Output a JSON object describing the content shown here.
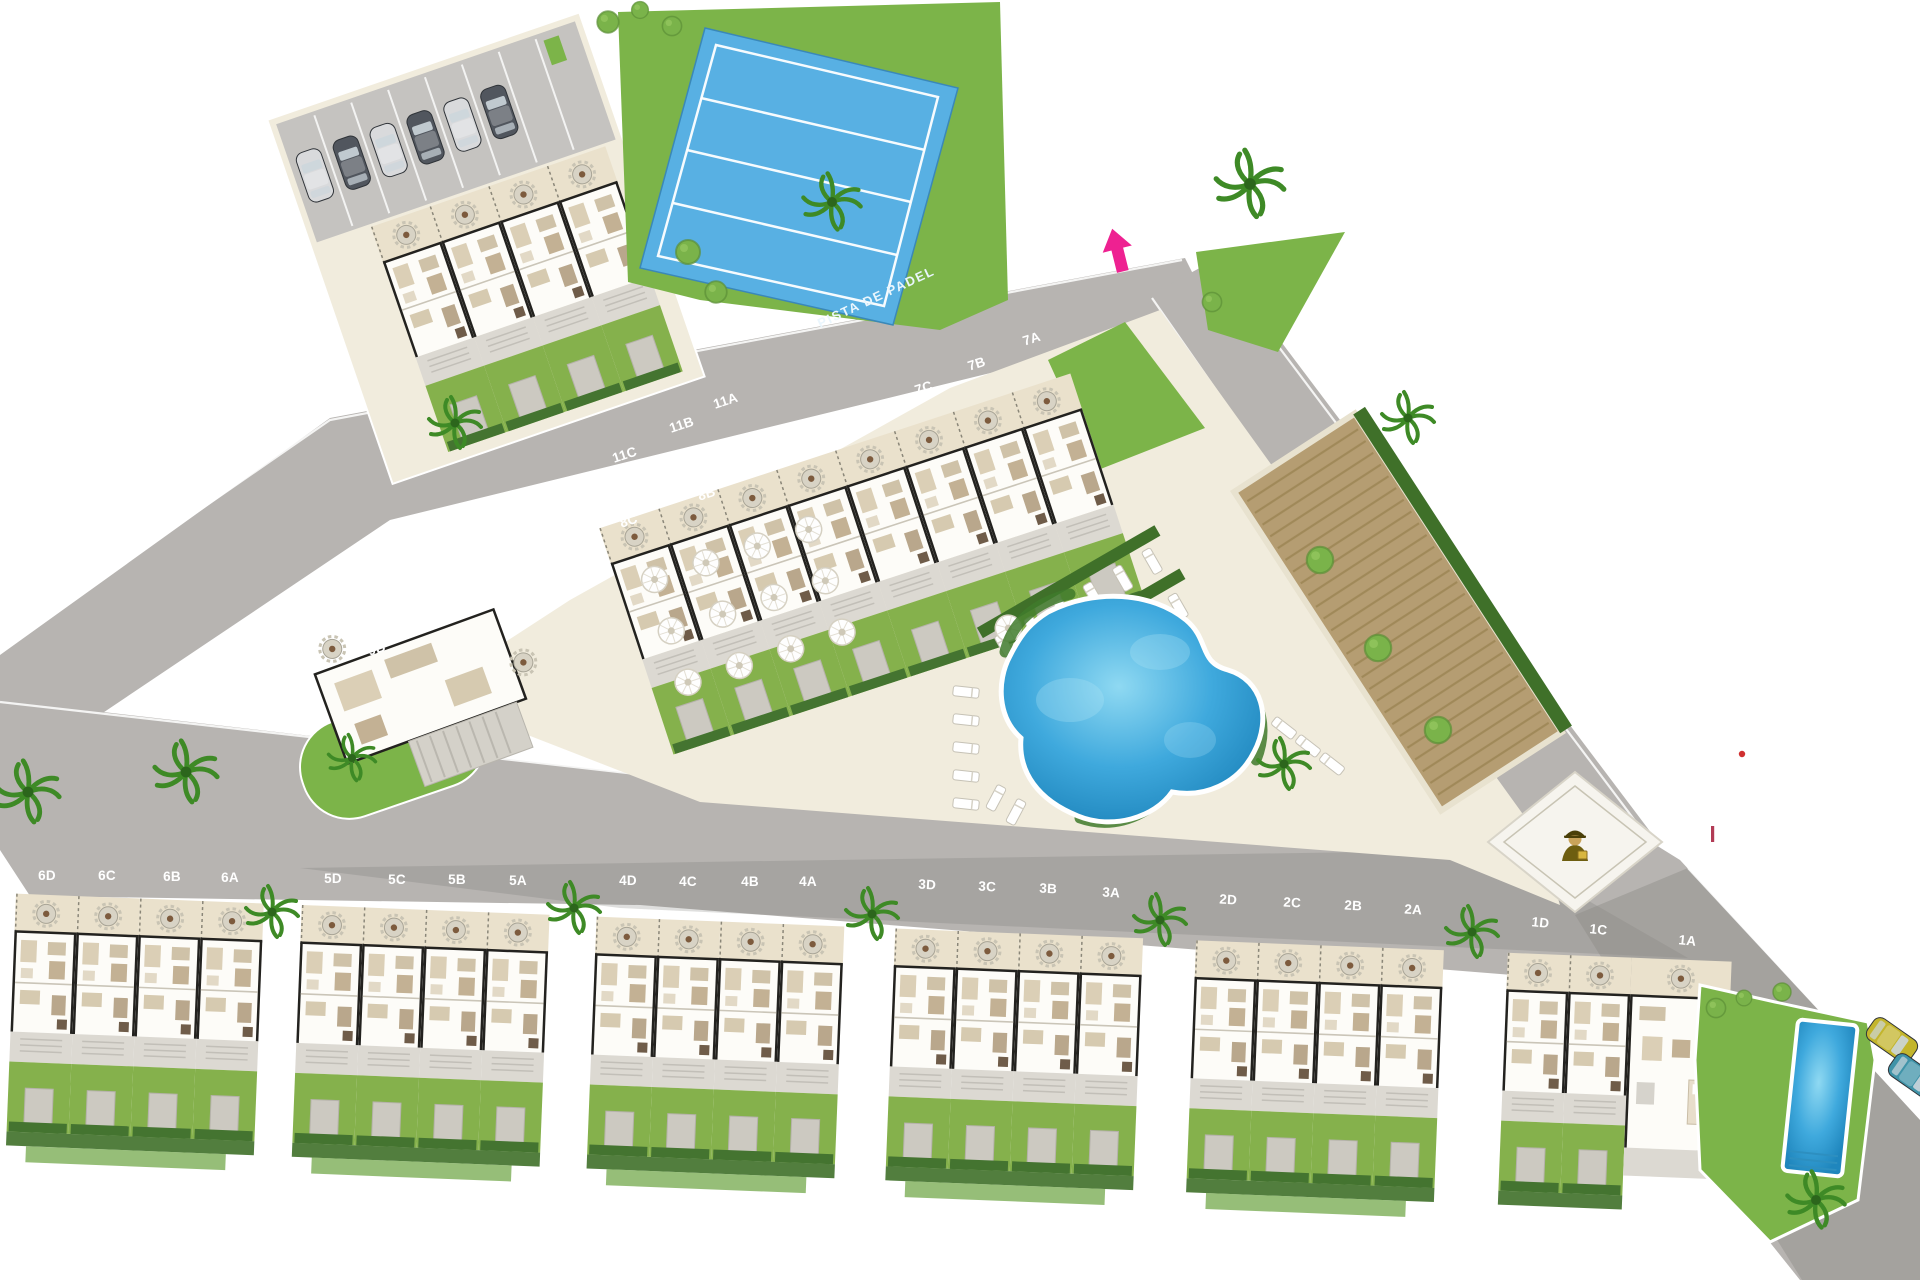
{
  "site_plan": {
    "court_label": "PISTA DE PADEL",
    "unit_rows": {
      "row11": [
        "11A",
        "11B",
        "11C",
        "11D"
      ],
      "row9": [
        "9A",
        "9B"
      ],
      "row8": [
        "8A",
        "8B",
        "8C",
        "8D"
      ],
      "row7": [
        "7A",
        "7B",
        "7C",
        "7D"
      ],
      "row6": [
        "6D",
        "6C",
        "6B",
        "6A"
      ],
      "row5": [
        "5D",
        "5C",
        "5B",
        "5A"
      ],
      "row4": [
        "4D",
        "4C",
        "4B",
        "4A"
      ],
      "row3": [
        "3D",
        "3C",
        "3B",
        "3A"
      ],
      "row2": [
        "2D",
        "2C",
        "2B",
        "2A"
      ],
      "row1": [
        "1D",
        "1C",
        "1A"
      ]
    }
  },
  "colors": {
    "road": "#b7b4b1",
    "pavement": "#f1ecdd",
    "lawn": "#7cb449",
    "hedge": "#3f7029",
    "padel_blue": "#58b0e3",
    "pool_blue": "#2f9fd6",
    "soil": "#b59d72",
    "accent_pink": "#ee2191",
    "label_white": "#ffffff",
    "car_dark": "#51565e",
    "car_silver": "#d9dadc",
    "car_yellow": "#c3b52c",
    "car_teal": "#3f93a8",
    "guard_gold": "#6e5e10"
  }
}
